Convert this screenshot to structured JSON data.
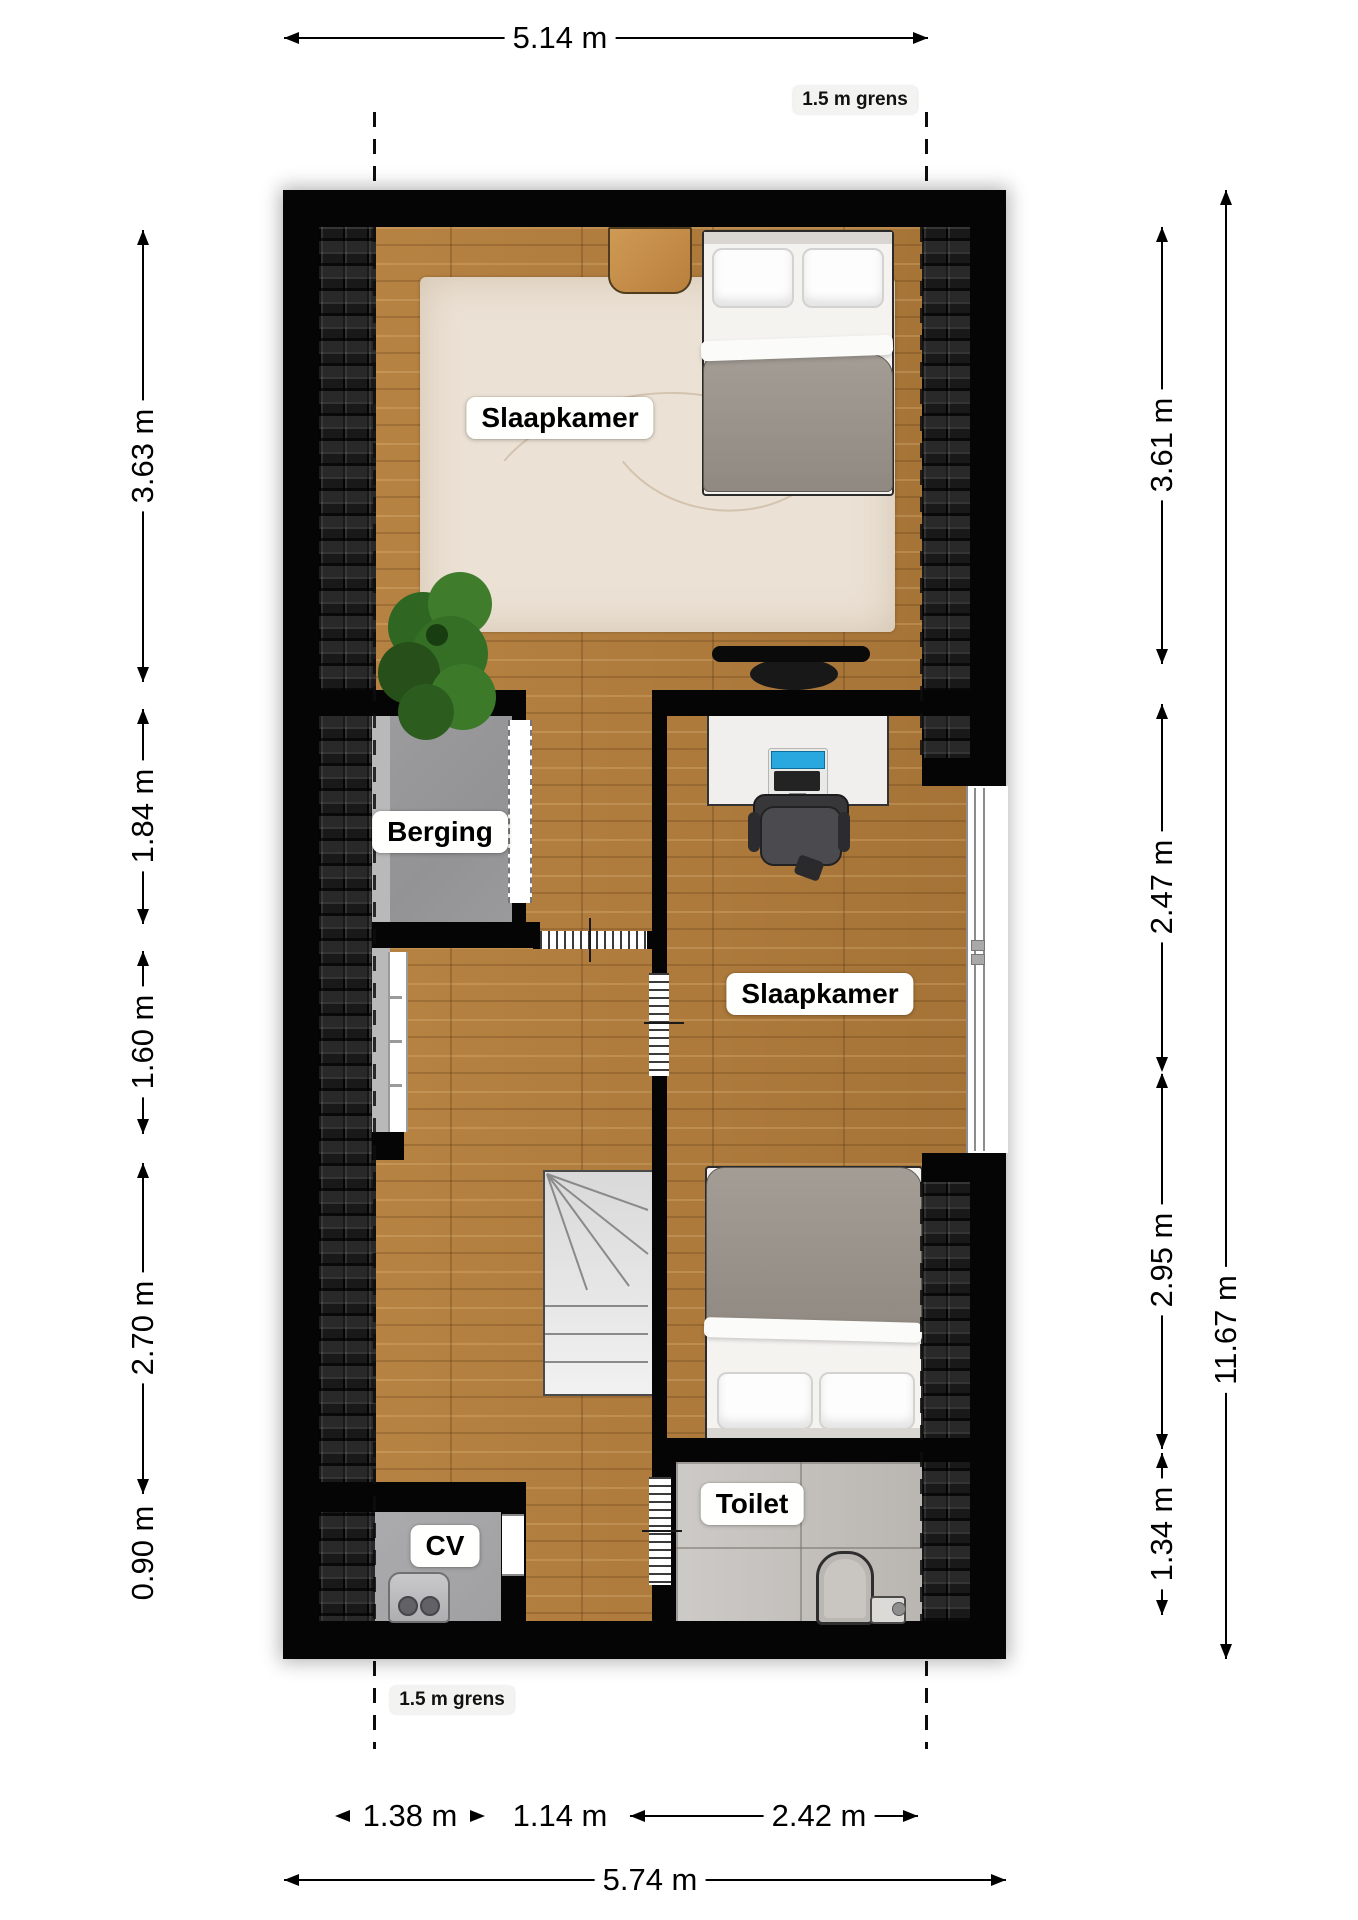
{
  "plan": {
    "type": "floorplan",
    "language": "nl",
    "rooms": {
      "bedroom_top": "Slaapkamer",
      "bedroom_right": "Slaapkamer",
      "storage": "Berging",
      "toilet": "Toilet",
      "heating": "CV"
    },
    "boundary": {
      "top_label": "1.5 m grens",
      "bottom_label": "1.5 m grens"
    },
    "dimensions": {
      "top": "5.14 m",
      "left": [
        "3.63 m",
        "1.84 m",
        "1.60 m",
        "2.70 m",
        "0.90 m"
      ],
      "right": [
        "3.61 m",
        "2.47 m",
        "2.95 m",
        "1.34 m"
      ],
      "right_total": "11.67 m",
      "bottom_parts": [
        "1.38 m",
        "1.14 m",
        "2.42 m"
      ],
      "bottom_total": "5.74 m"
    },
    "objects": [
      "double-bed",
      "single-bed",
      "nightstand",
      "rug",
      "plant",
      "tv",
      "desk",
      "laptop",
      "office-chair",
      "stairs",
      "railing",
      "cv-boiler",
      "toilet-bowl",
      "cistern",
      "dormer-window",
      "knee-window"
    ],
    "colors": {
      "wall": "#050505",
      "wood_floor": "#b07c3d",
      "roof_tiles": "#191919",
      "storage_floor": "#98989a",
      "toilet_floor": "#c6c3bf",
      "rug": "#ebe1d4",
      "laptop_screen": "#29a8df",
      "background": "#ffffff"
    }
  }
}
